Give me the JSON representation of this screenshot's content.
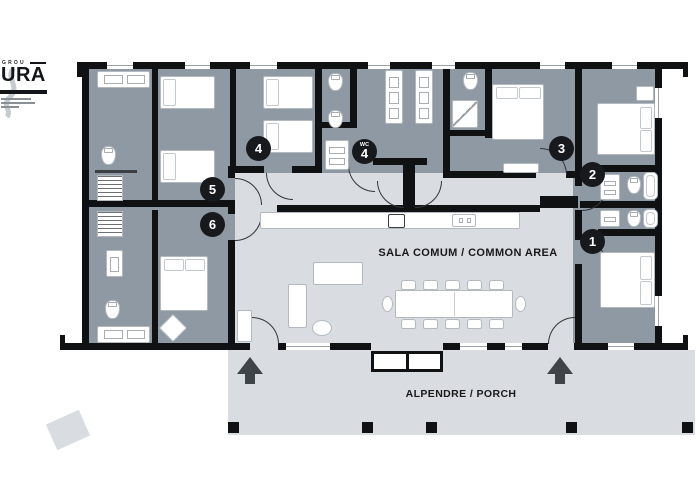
{
  "logo": {
    "top_text": "GROU",
    "main_text": "URA"
  },
  "labels": {
    "common_area": "SALA COMUM / COMMON AREA",
    "porch": "ALPENDRE / PORCH"
  },
  "markers": [
    {
      "key": "m1",
      "number": "1"
    },
    {
      "key": "m2",
      "number": "2"
    },
    {
      "key": "m3",
      "number": "3"
    },
    {
      "key": "m4",
      "number": "4"
    },
    {
      "key": "mwc4",
      "number": "4",
      "prefix": "WC"
    },
    {
      "key": "m5",
      "number": "5"
    },
    {
      "key": "m6",
      "number": "6"
    }
  ],
  "colors": {
    "wall": "#101113",
    "room_fill": "#8e99a4",
    "common_fill": "#d9dce0",
    "badge": "#17191c",
    "arrow": "#3f4449"
  }
}
